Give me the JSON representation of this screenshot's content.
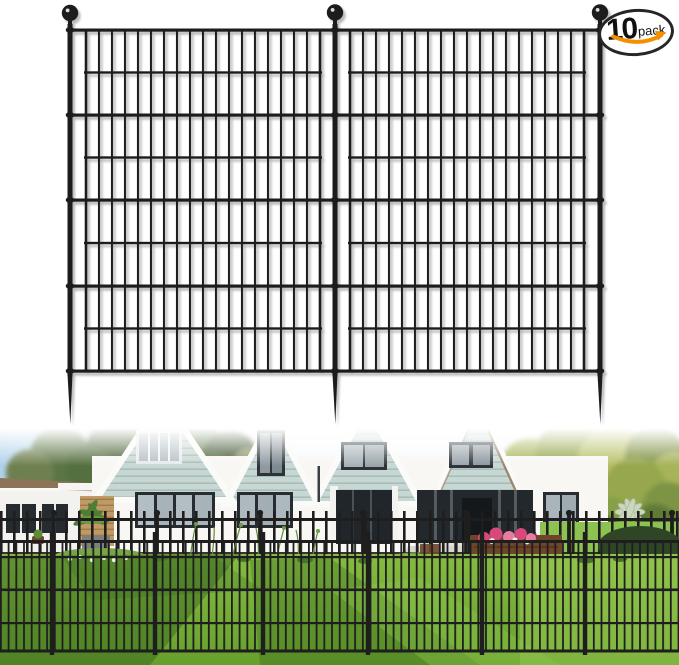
{
  "badge": {
    "count": "10",
    "unit": "pack"
  },
  "icons": {
    "smile_arrow": "orange-smile-arrow"
  },
  "colors": {
    "fence_black": "#1e1e1e",
    "badge_border": "#262626",
    "accent_orange": "#f49000",
    "siding_teal": "#c7d7d3",
    "sky_blue": "#9cc8e8",
    "lawn_green": "#79b13a",
    "lawn_shadow": "#2f5a1a",
    "flower_pink": "#d9487a",
    "brick_tan": "#c09a66",
    "roof_brown": "#8d7458",
    "bench_brown": "#6e452a"
  }
}
